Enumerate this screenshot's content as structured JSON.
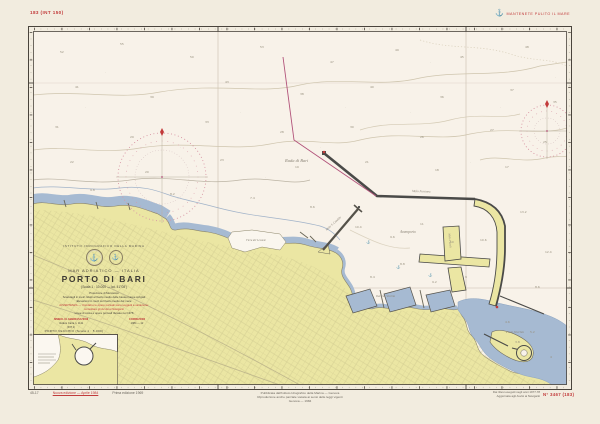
{
  "chart": {
    "corner_number_top_left": "183 (INT 150)",
    "slogan": {
      "icon": "anchor-icon",
      "text": "MANTENETE PULITO IL MARE"
    },
    "title_block": {
      "agency": "ISTITUTO IDROGRAFICO DELLA MARINA",
      "region": "MAR ADRIATICO — ITALIA",
      "title": "PORTO DI BARI",
      "scale": "(Scala 1 : 10.000 — lat. 41°08′)",
      "notes": [
        {
          "text": "Proiezione di Mercatore"
        },
        {
          "text": "Scandagli in metri ridotti al livello medio delle basse maree sizigiali"
        },
        {
          "text": "Elevazioni in metri sul livello medio del mare"
        },
        {
          "text": "AVVERTENZA — I fondali e le opere portuali sono soggetti a variazione:"
        },
        {
          "text": "consultare gli Avvisi ai Naviganti"
        },
        {
          "text": "Linee di costa e opere portuali rilevate nel 1978"
        }
      ],
      "col_left": {
        "header": "SIMBOLI E ABBREVIAZIONI",
        "line1": "Vedere Carta n. 1111",
        "line2": "(INT 1)"
      },
      "col_right": {
        "header": "CORREZIONI",
        "line1": "1984 — 12",
        "line2": "—"
      }
    },
    "inset": {
      "title": "PORTO VECCHIO",
      "scale": "(Scala 1 : 5.000)"
    },
    "bottom": {
      "left_code": "45-17",
      "left_red_note": "Nuova edizione — Aprile 1984",
      "left_black_note": "Prima edizione 1969",
      "center_lines": [
        "Pubblicata dall'Istituto Idrografico della Marina — Genova",
        "Riproduzione anche parziale vietata ai sensi delle leggi vigenti",
        "Genova — 1984"
      ],
      "right_line1": "Dai rilievi eseguiti negli anni 1977-78",
      "right_line2": "Aggiornata agli Avvisi ai Naviganti",
      "right_red_number": "N° 3467 (183)"
    },
    "sea_labels": [
      {
        "t": "Rada di Bari",
        "x": 285,
        "y": 158,
        "r": 0,
        "s": 4.5
      },
      {
        "t": "Avamporto",
        "x": 400,
        "y": 230,
        "r": 0,
        "s": 3.6
      },
      {
        "t": "Molo Foraneo",
        "x": 412,
        "y": 189,
        "r": 2,
        "s": 3.2
      },
      {
        "t": "Molo S. Cataldo",
        "x": 326,
        "y": 228,
        "r": -42,
        "s": 3
      },
      {
        "t": "Molo Pizzoli",
        "x": 449,
        "y": 232,
        "r": 85,
        "s": 2.8
      },
      {
        "t": "Darsena Vecchia",
        "x": 376,
        "y": 295,
        "r": 0,
        "s": 2.8
      },
      {
        "t": "Porto Vecchio",
        "x": 506,
        "y": 330,
        "r": 0,
        "s": 3.2
      },
      {
        "t": "Fiera del Levante",
        "x": 246,
        "y": 239,
        "r": 0,
        "s": 2.8
      },
      {
        "t": "⚓",
        "x": 396,
        "y": 265,
        "r": 0,
        "s": 3.5
      },
      {
        "t": "⚓",
        "x": 428,
        "y": 273,
        "r": 0,
        "s": 3.5
      },
      {
        "t": "⚓",
        "x": 366,
        "y": 240,
        "r": 0,
        "s": 3.5
      }
    ],
    "soundings": [
      {
        "x": 60,
        "y": 50,
        "v": "52"
      },
      {
        "x": 120,
        "y": 42,
        "v": "55"
      },
      {
        "x": 190,
        "y": 55,
        "v": "50"
      },
      {
        "x": 260,
        "y": 45,
        "v": "53"
      },
      {
        "x": 330,
        "y": 60,
        "v": "47"
      },
      {
        "x": 395,
        "y": 48,
        "v": "49"
      },
      {
        "x": 460,
        "y": 55,
        "v": "45"
      },
      {
        "x": 525,
        "y": 45,
        "v": "48"
      },
      {
        "x": 75,
        "y": 85,
        "v": "41"
      },
      {
        "x": 150,
        "y": 95,
        "v": "39"
      },
      {
        "x": 225,
        "y": 80,
        "v": "43"
      },
      {
        "x": 300,
        "y": 92,
        "v": "38"
      },
      {
        "x": 370,
        "y": 85,
        "v": "40"
      },
      {
        "x": 440,
        "y": 95,
        "v": "36"
      },
      {
        "x": 510,
        "y": 88,
        "v": "37"
      },
      {
        "x": 553,
        "y": 100,
        "v": "35"
      },
      {
        "x": 55,
        "y": 125,
        "v": "31"
      },
      {
        "x": 130,
        "y": 135,
        "v": "29"
      },
      {
        "x": 205,
        "y": 120,
        "v": "33"
      },
      {
        "x": 280,
        "y": 130,
        "v": "28"
      },
      {
        "x": 350,
        "y": 125,
        "v": "30"
      },
      {
        "x": 420,
        "y": 135,
        "v": "26"
      },
      {
        "x": 490,
        "y": 128,
        "v": "27"
      },
      {
        "x": 543,
        "y": 140,
        "v": "25"
      },
      {
        "x": 70,
        "y": 160,
        "v": "22"
      },
      {
        "x": 145,
        "y": 170,
        "v": "20"
      },
      {
        "x": 220,
        "y": 158,
        "v": "23"
      },
      {
        "x": 295,
        "y": 165,
        "v": "19"
      },
      {
        "x": 365,
        "y": 160,
        "v": "21"
      },
      {
        "x": 435,
        "y": 168,
        "v": "18"
      },
      {
        "x": 505,
        "y": 165,
        "v": "17"
      },
      {
        "x": 90,
        "y": 188,
        "v": "9.8"
      },
      {
        "x": 170,
        "y": 192,
        "v": "8.2"
      },
      {
        "x": 250,
        "y": 196,
        "v": "7.4"
      },
      {
        "x": 310,
        "y": 205,
        "v": "8.6"
      },
      {
        "x": 355,
        "y": 225,
        "v": "10.4"
      },
      {
        "x": 390,
        "y": 235,
        "v": "9.6"
      },
      {
        "x": 420,
        "y": 222,
        "v": "11"
      },
      {
        "x": 450,
        "y": 240,
        "v": "10"
      },
      {
        "x": 400,
        "y": 262,
        "v": "8.8"
      },
      {
        "x": 370,
        "y": 275,
        "v": "8.4"
      },
      {
        "x": 432,
        "y": 280,
        "v": "9.2"
      },
      {
        "x": 465,
        "y": 275,
        "v": "9"
      },
      {
        "x": 480,
        "y": 238,
        "v": "10.6"
      },
      {
        "x": 505,
        "y": 320,
        "v": "4.6"
      },
      {
        "x": 530,
        "y": 330,
        "v": "5.2"
      },
      {
        "x": 550,
        "y": 355,
        "v": "4"
      },
      {
        "x": 515,
        "y": 340,
        "v": "3.8"
      },
      {
        "x": 520,
        "y": 210,
        "v": "13.2"
      },
      {
        "x": 545,
        "y": 250,
        "v": "12.4"
      },
      {
        "x": 535,
        "y": 285,
        "v": "8.6"
      },
      {
        "x": 105,
        "y": 70,
        "v": "·"
      },
      {
        "x": 240,
        "y": 110,
        "v": "·"
      },
      {
        "x": 320,
        "y": 145,
        "v": "·"
      },
      {
        "x": 410,
        "y": 110,
        "v": "·"
      },
      {
        "x": 470,
        "y": 160,
        "v": "·"
      },
      {
        "x": 555,
        "y": 75,
        "v": "·"
      },
      {
        "x": 180,
        "y": 145,
        "v": "·"
      },
      {
        "x": 85,
        "y": 105,
        "v": "·"
      },
      {
        "x": 265,
        "y": 175,
        "v": "·"
      },
      {
        "x": 345,
        "y": 105,
        "v": "·"
      },
      {
        "x": 500,
        "y": 105,
        "v": "·"
      },
      {
        "x": 430,
        "y": 60,
        "v": "·"
      }
    ],
    "colors": {
      "paper": "#f2ecdf",
      "sea": "#f8f2e9",
      "land": "#ebe6a3",
      "shallow_water": "#a6bad2",
      "breakwater": "#4a4a48",
      "accent_red": "#c23b3b",
      "magenta_line": "#b2537a",
      "compass_rose": "#d897a5",
      "contour": "#cfc5ae"
    }
  }
}
